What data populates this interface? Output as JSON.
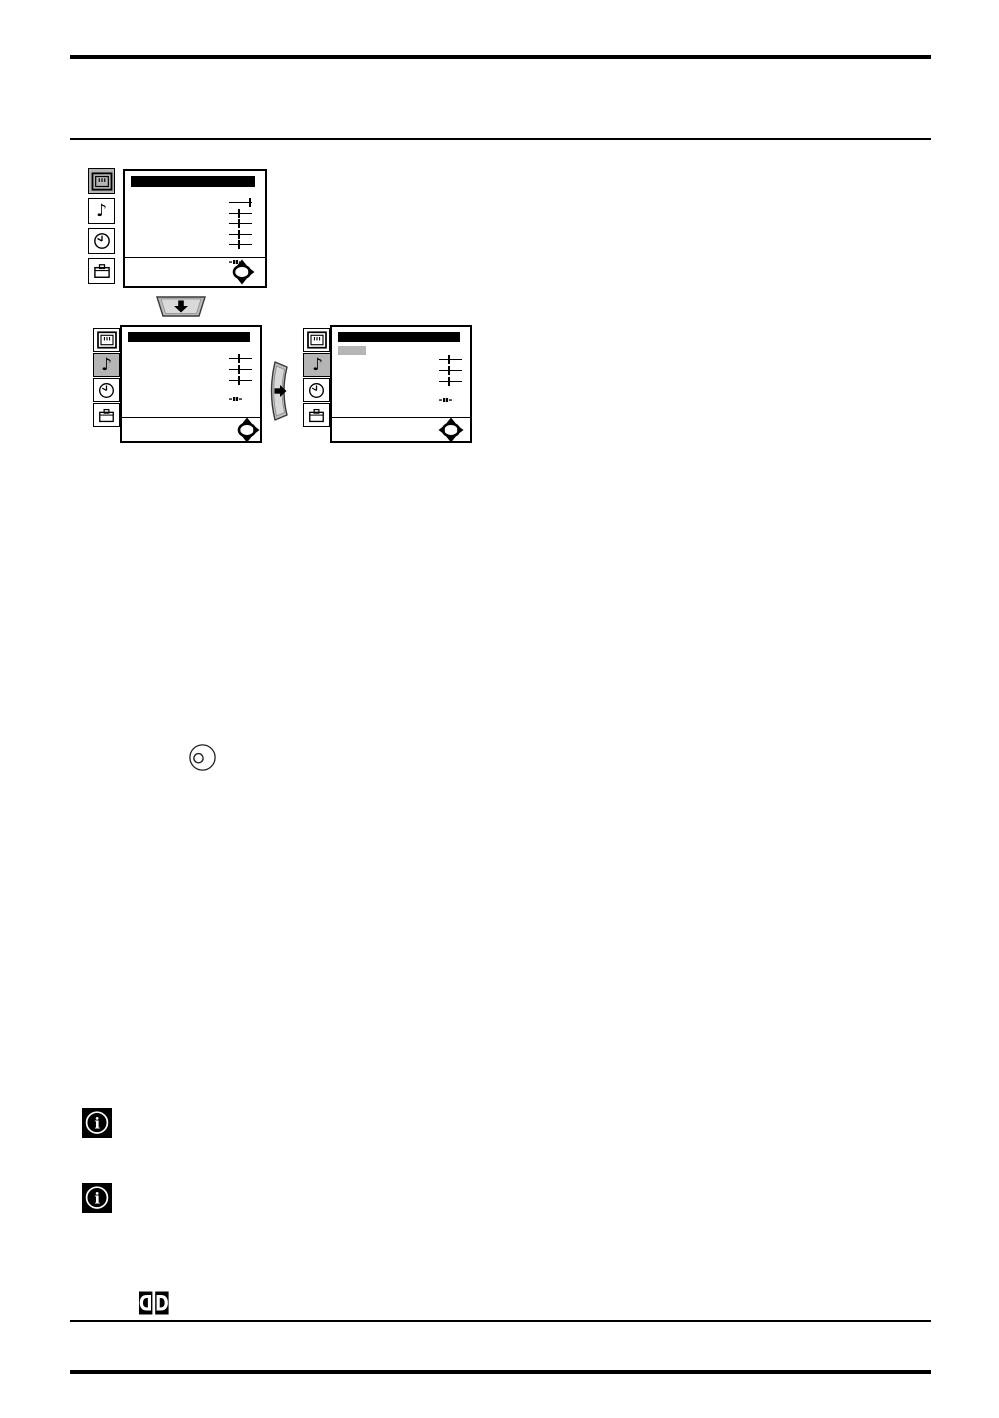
{
  "page": {
    "background": "#ffffff",
    "line_color": "#000000"
  },
  "osd": {
    "selected_bg": "#b5b5b5",
    "title_bar_color": "#000000",
    "icon_names": [
      "picture",
      "sound",
      "timer",
      "service"
    ],
    "menus": [
      {
        "name": "picture-menu",
        "selected_icon": "picture",
        "sliders": [
          {
            "pos": "end"
          },
          {
            "pos": "mid"
          },
          {
            "pos": "mid"
          },
          {
            "pos": "mid"
          },
          {
            "pos": "mid"
          }
        ],
        "nav_arrows": [
          "up",
          "down",
          "right"
        ],
        "has_selected_item": false
      },
      {
        "name": "sound-menu",
        "selected_icon": "sound",
        "sliders": [
          {
            "pos": "mid"
          },
          {
            "pos": "mid"
          },
          {
            "pos": "mid"
          }
        ],
        "nav_arrows": [
          "up",
          "down",
          "right"
        ],
        "has_selected_item": false
      },
      {
        "name": "sound-menu-item-selected",
        "selected_icon": "sound",
        "sliders": [
          {
            "pos": "mid"
          },
          {
            "pos": "mid"
          },
          {
            "pos": "mid"
          }
        ],
        "nav_arrows": [
          "up",
          "down",
          "left",
          "right"
        ],
        "has_selected_item": true
      }
    ]
  },
  "remote_keys": [
    {
      "name": "cursor-down-key",
      "arrow": "down"
    },
    {
      "name": "cursor-right-key",
      "arrow": "right"
    }
  ],
  "symbols": {
    "note_glyph": "♪",
    "info_glyph": "i",
    "dolby_left": "D",
    "dolby_right": "D"
  }
}
